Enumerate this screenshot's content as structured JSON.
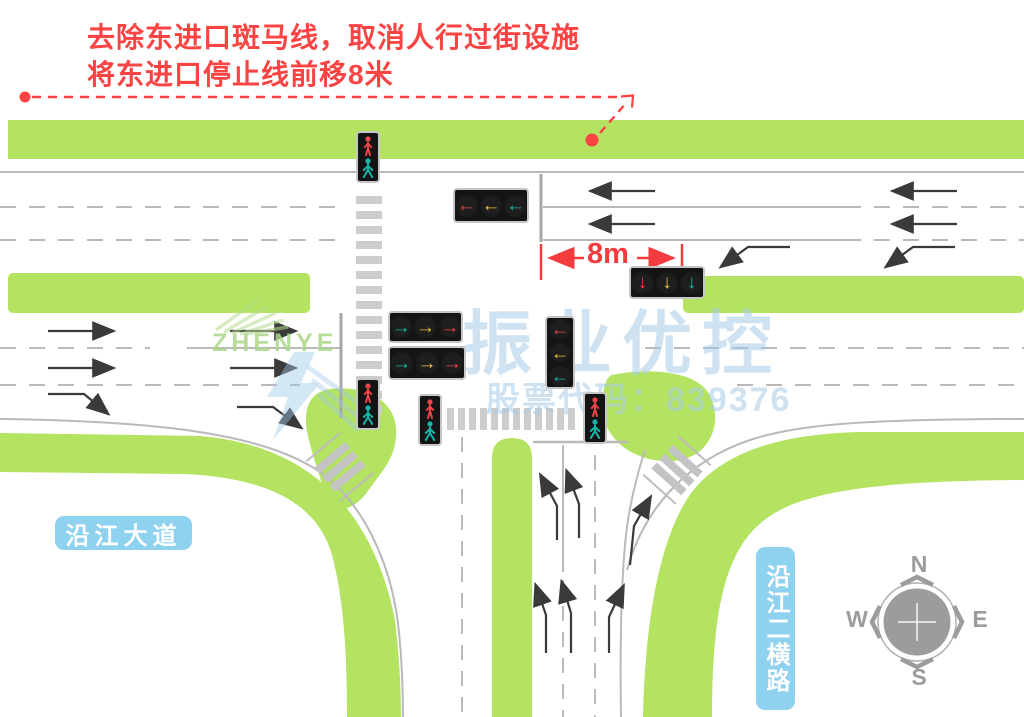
{
  "annotation": {
    "line1": "去除东进口斑马线，取消人行过街设施",
    "line2": "将东进口停止线前移8米",
    "dimension_label": "8m"
  },
  "road_labels": {
    "east_west_road": "沿江大道",
    "north_south_road": "沿江二横路"
  },
  "compass": {
    "north": "N",
    "south": "S",
    "west": "W",
    "east": "E"
  },
  "watermark": {
    "brand": "振业优控",
    "stock_code_label": "股票代码：839376",
    "logo_text": "ZHENYE"
  },
  "signals": {
    "palette": {
      "red": "#ee4548",
      "yellow": "#edc33d",
      "green": "#16b5a8"
    },
    "boxes": [
      {
        "name": "east-approach-left-turn-signal",
        "orientation": "horizontal",
        "glyphs": [
          "←",
          "←",
          "←"
        ],
        "colors": [
          "red",
          "yellow",
          "green"
        ]
      },
      {
        "name": "east-approach-through-signal",
        "orientation": "horizontal",
        "glyphs": [
          "↓",
          "↓",
          "↓"
        ],
        "colors": [
          "red",
          "yellow",
          "green"
        ]
      },
      {
        "name": "west-approach-signal-row-1",
        "orientation": "horizontal",
        "glyphs": [
          "→",
          "→",
          "→"
        ],
        "colors": [
          "green",
          "yellow",
          "red"
        ]
      },
      {
        "name": "west-approach-signal-row-2",
        "orientation": "horizontal",
        "glyphs": [
          "→",
          "→",
          "→"
        ],
        "colors": [
          "green",
          "yellow",
          "red"
        ]
      },
      {
        "name": "south-road-left-turn-signal",
        "orientation": "vertical",
        "glyphs": [
          "←",
          "←",
          "←"
        ],
        "colors": [
          "red",
          "yellow",
          "green"
        ]
      }
    ]
  },
  "colors": {
    "green_belt": "#b3e361",
    "road_line": "#b9b9b9",
    "crosswalk": "#cdcdcd",
    "lane_arrow": "#3a3a3a",
    "annotation_red": "#fa4343",
    "badge_blue": "#8fd2f0",
    "compass_gray": "#9c9c9c",
    "watermark_blue": "#a6cae7"
  }
}
